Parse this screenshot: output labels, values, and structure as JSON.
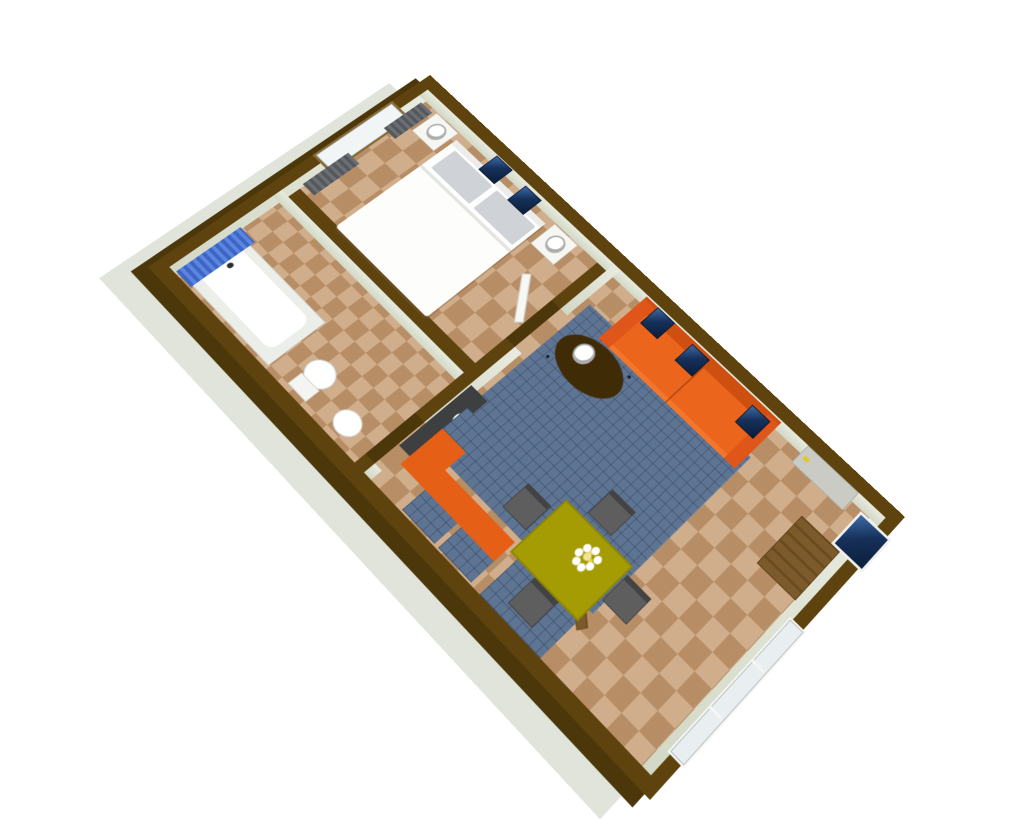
{
  "scene": {
    "type": "3D floor plan render, aerial oblique view, rotated ~45 degrees",
    "background": "#ffffff",
    "palette": {
      "wall_top": "#5e430e",
      "wall_exterior_face": "#4c370b",
      "wall_inner_face": "#dfe3d4",
      "foundation_slab": "#e0e4da",
      "floor_tile": "#c79c73",
      "rug_blue": "#5e7493",
      "sofa_orange": "#e65f17",
      "dining_table_olive": "#a59b03",
      "chair_gray": "#5e5e5e",
      "entry_door_gray": "#c9cbc4",
      "door_handle_yellow": "#e3c81f",
      "picture_navy": "#16305a",
      "shower_curtain_blue": "#4470d0",
      "window_curtain_gray": "#5c6064",
      "wood_cabinet": "#7c5a2b",
      "fixtures_white": "#f7f7f4"
    },
    "rooms": [
      {
        "name": "Bedroom",
        "furniture": [
          "double bed with white duvet and two gray pillows",
          "white nightstand with round lamp (left)",
          "white nightstand with round lamp (right)",
          "window with brown frame and two dark gray curtains",
          "two navy wall pictures",
          "open white door"
        ]
      },
      {
        "name": "Bathroom",
        "furniture": [
          "bathtub with blue shower curtain",
          "toilet",
          "pedestal sink",
          "open white door"
        ]
      },
      {
        "name": "Living room",
        "furniture": [
          "orange two-seat sofa against north wall",
          "blue grid area rug",
          "dark brown oval coffee table with white lamp",
          "three navy wall pictures",
          "gray entrance door with yellow handle",
          "wall TV with white frame",
          "wooden TV cabinet",
          "long window in east wall",
          "olive dining table with white daisy bouquet",
          "four gray chairs",
          "orange kitchen bench with blue units",
          "dark storage unit with white basin",
          "blue entry mat with wooden board"
        ]
      }
    ]
  }
}
